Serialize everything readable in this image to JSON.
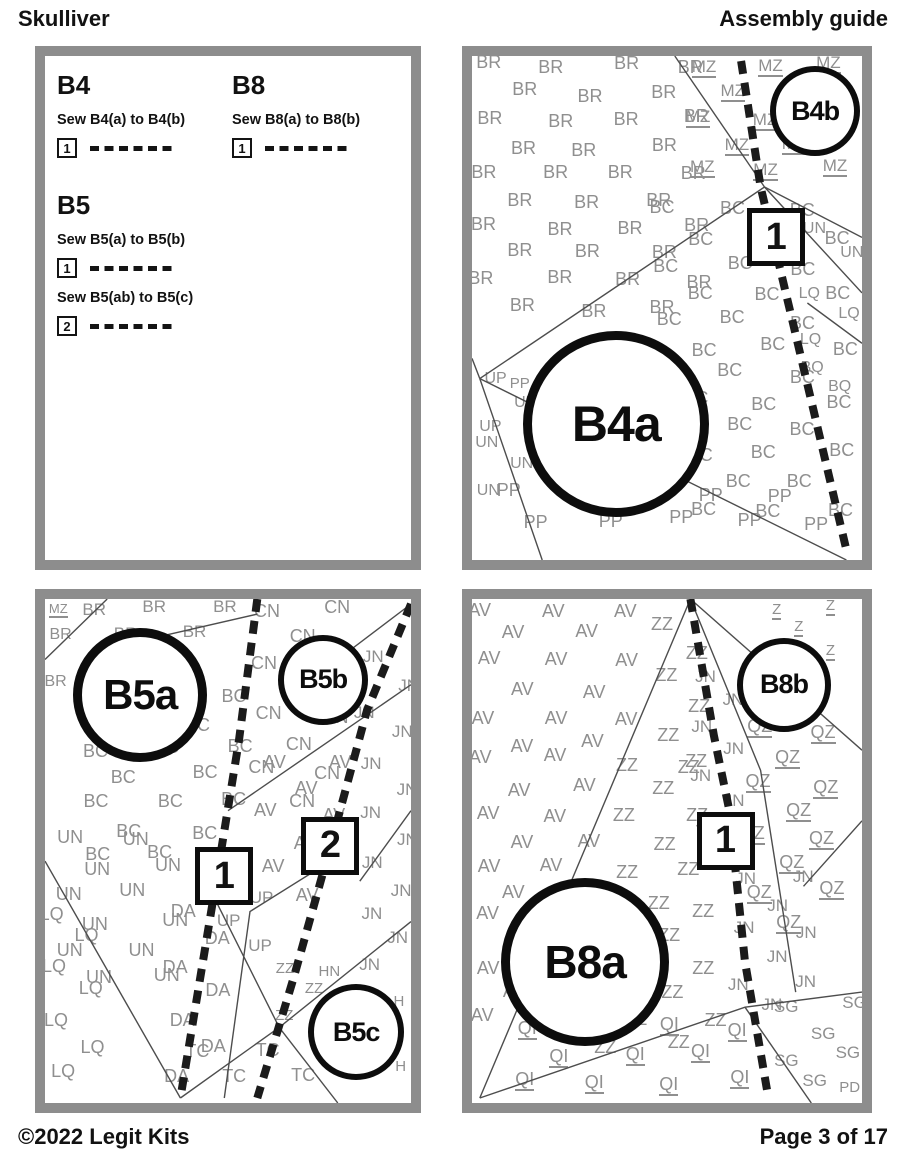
{
  "header": {
    "title_left": "Skulliver",
    "title_right": "Assembly guide"
  },
  "footer": {
    "copyright": "©2022 Legit Kits",
    "page": "Page 3 of 17"
  },
  "colors": {
    "panel_border": "#8d8d8d",
    "letters": "#8f8f8f",
    "thin_line": "#4d4d4d",
    "ink": "#0d0d0d",
    "paper": "#ffffff"
  },
  "instructions": {
    "groups": [
      {
        "title": "B4",
        "col": 0,
        "row": 0,
        "steps": [
          {
            "num": "1",
            "text": "Sew B4(a) to B4(b)"
          }
        ]
      },
      {
        "title": "B8",
        "col": 1,
        "row": 0,
        "steps": [
          {
            "num": "1",
            "text": "Sew B8(a) to B8(b)"
          }
        ]
      },
      {
        "title": "B5",
        "col": 0,
        "row": 1,
        "steps": [
          {
            "num": "1",
            "text": "Sew B5(a) to B5(b)"
          },
          {
            "num": "2",
            "text": "Sew B5(ab) to B5(c)"
          }
        ]
      }
    ]
  },
  "panels": [
    {
      "id": "B4",
      "circles": [
        {
          "label": "B4b",
          "x": 88,
          "y": 11,
          "r": 45,
          "fs": 27,
          "cls": "sm"
        },
        {
          "label": "B4a",
          "x": 37,
          "y": 73,
          "r": 93,
          "fs": 50,
          "cls": "lg"
        }
      ],
      "boxes": [
        {
          "num": "1",
          "x": 78,
          "y": 36
        }
      ],
      "dashed": [
        [
          [
            69,
            1
          ],
          [
            74,
            26
          ],
          [
            82,
            52
          ],
          [
            96,
            98
          ]
        ]
      ],
      "lines": [
        [
          [
            52,
            0
          ],
          [
            75,
            26
          ]
        ],
        [
          [
            75,
            26
          ],
          [
            100,
            36
          ]
        ],
        [
          [
            75,
            26
          ],
          [
            100,
            47
          ]
        ],
        [
          [
            75,
            26
          ],
          [
            2,
            64
          ]
        ],
        [
          [
            2,
            64
          ],
          [
            96,
            100
          ]
        ],
        [
          [
            2,
            64
          ],
          [
            18,
            100
          ]
        ],
        [
          [
            2,
            64
          ],
          [
            0,
            60
          ]
        ],
        [
          [
            86,
            49
          ],
          [
            100,
            57
          ]
        ]
      ],
      "fields": [
        {
          "code": "BR",
          "x": 0,
          "y": 0,
          "w": 64,
          "h": 54,
          "fs": 18
        },
        {
          "code": "MZ",
          "u": true,
          "x": 55,
          "y": 0,
          "w": 44,
          "h": 26,
          "fs": 17
        },
        {
          "code": "BR",
          "x": 91,
          "y": 15,
          "w": 8,
          "h": 6,
          "fs": 15
        },
        {
          "code": "BC",
          "x": 46,
          "y": 29,
          "w": 49,
          "h": 62,
          "fs": 18
        },
        {
          "code": "UN",
          "x": 86,
          "y": 33,
          "w": 13,
          "h": 9,
          "fs": 16
        },
        {
          "code": "LQ",
          "x": 85,
          "y": 45,
          "w": 14,
          "h": 13,
          "fs": 16
        },
        {
          "code": "BQ",
          "x": 83,
          "y": 60,
          "w": 16,
          "h": 10,
          "fs": 16
        },
        {
          "code": "UP",
          "x": 2,
          "y": 62,
          "w": 13,
          "h": 14,
          "fs": 16
        },
        {
          "code": "UN",
          "x": 1,
          "y": 75,
          "w": 15,
          "h": 14,
          "fs": 16
        },
        {
          "code": "PP",
          "x": 5,
          "y": 85,
          "w": 90,
          "h": 13,
          "fs": 18
        },
        {
          "code": "PP",
          "x": 11,
          "y": 63,
          "w": 10,
          "h": 11,
          "fs": 15
        }
      ]
    },
    {
      "id": "B5",
      "circles": [
        {
          "label": "B5a",
          "x": 26,
          "y": 19,
          "r": 67,
          "fs": 42,
          "cls": "lg"
        },
        {
          "label": "B5b",
          "x": 76,
          "y": 16,
          "r": 45,
          "fs": 27,
          "cls": "sm"
        },
        {
          "label": "B5c",
          "x": 85,
          "y": 86,
          "r": 48,
          "fs": 27,
          "cls": "sm"
        }
      ],
      "boxes": [
        {
          "num": "1",
          "x": 49,
          "y": 55
        },
        {
          "num": "2",
          "x": 78,
          "y": 49
        }
      ],
      "dashed": [
        [
          [
            58,
            0
          ],
          [
            53,
            28
          ],
          [
            47,
            55
          ],
          [
            42,
            77
          ],
          [
            37,
            99
          ]
        ],
        [
          [
            100,
            1
          ],
          [
            88,
            22
          ],
          [
            78,
            49
          ],
          [
            68,
            75
          ],
          [
            58,
            99
          ]
        ]
      ],
      "lines": [
        [
          [
            0,
            12
          ],
          [
            17,
            0
          ]
        ],
        [
          [
            28,
            8
          ],
          [
            58,
            3
          ]
        ],
        [
          [
            80,
            12
          ],
          [
            100,
            1
          ]
        ],
        [
          [
            50,
            42
          ],
          [
            100,
            17
          ]
        ],
        [
          [
            0,
            52
          ],
          [
            37,
            99
          ]
        ],
        [
          [
            37,
            99
          ],
          [
            64,
            85
          ]
        ],
        [
          [
            64,
            85
          ],
          [
            44,
            56
          ]
        ],
        [
          [
            64,
            85
          ],
          [
            100,
            64
          ]
        ],
        [
          [
            64,
            85
          ],
          [
            80,
            100
          ]
        ],
        [
          [
            78,
            52
          ],
          [
            56,
            62
          ],
          [
            49,
            99
          ]
        ],
        [
          [
            100,
            42
          ],
          [
            86,
            56
          ]
        ]
      ],
      "fields": [
        {
          "code": "MZ",
          "u": true,
          "x": 1,
          "y": 0,
          "w": 9,
          "h": 6,
          "fs": 13
        },
        {
          "code": "BR",
          "x": 10,
          "y": 0,
          "w": 48,
          "h": 12,
          "fs": 17
        },
        {
          "code": "BR",
          "x": 0,
          "y": 6,
          "w": 12,
          "h": 16,
          "fs": 16
        },
        {
          "code": "BC",
          "x": 10,
          "y": 17,
          "w": 46,
          "h": 35,
          "fs": 18
        },
        {
          "code": "CN",
          "x": 56,
          "y": 0,
          "w": 32,
          "h": 42,
          "fs": 18
        },
        {
          "code": "AV",
          "x": 58,
          "y": 30,
          "w": 30,
          "h": 32,
          "fs": 18
        },
        {
          "code": "JN",
          "x": 86,
          "y": 10,
          "w": 13,
          "h": 68,
          "fs": 17
        },
        {
          "code": "UN",
          "x": 2,
          "y": 46,
          "w": 38,
          "h": 34,
          "fs": 18
        },
        {
          "code": "LQ",
          "x": 0,
          "y": 60,
          "w": 21,
          "h": 38,
          "fs": 18
        },
        {
          "code": "DA",
          "x": 33,
          "y": 60,
          "w": 21,
          "h": 36,
          "fs": 18
        },
        {
          "code": "UP",
          "x": 48,
          "y": 52,
          "w": 20,
          "h": 22,
          "fs": 17
        },
        {
          "code": "ZZ",
          "x": 62,
          "y": 72,
          "w": 15,
          "h": 13,
          "fs": 15
        },
        {
          "code": "HN",
          "x": 74,
          "y": 72,
          "w": 9,
          "h": 7,
          "fs": 15
        },
        {
          "code": "TC",
          "x": 38,
          "y": 88,
          "w": 34,
          "h": 11,
          "fs": 18
        },
        {
          "code": "H",
          "x": 96,
          "y": 78,
          "w": 5,
          "h": 7,
          "fs": 15
        },
        {
          "code": "G",
          "x": 95,
          "y": 85,
          "w": 5,
          "h": 7,
          "fs": 15
        },
        {
          "code": "H",
          "x": 96,
          "y": 91,
          "w": 5,
          "h": 6,
          "fs": 15
        }
      ]
    },
    {
      "id": "B8",
      "circles": [
        {
          "label": "B8b",
          "x": 80,
          "y": 17,
          "r": 47,
          "fs": 27,
          "cls": "sm"
        },
        {
          "label": "B8a",
          "x": 29,
          "y": 72,
          "r": 84,
          "fs": 46,
          "cls": "lg"
        }
      ],
      "boxes": [
        {
          "num": "1",
          "x": 65,
          "y": 48
        }
      ],
      "dashed": [
        [
          [
            56,
            0
          ],
          [
            62,
            27
          ],
          [
            66,
            42
          ],
          [
            70,
            72
          ],
          [
            76,
            99
          ]
        ]
      ],
      "lines": [
        [
          [
            56,
            0
          ],
          [
            2,
            99
          ]
        ],
        [
          [
            56,
            0
          ],
          [
            100,
            30
          ]
        ],
        [
          [
            56,
            0
          ],
          [
            74,
            34
          ],
          [
            83,
            78
          ]
        ],
        [
          [
            2,
            99
          ],
          [
            70,
            81
          ],
          [
            100,
            78
          ]
        ],
        [
          [
            70,
            81
          ],
          [
            87,
            100
          ]
        ],
        [
          [
            100,
            44
          ],
          [
            85,
            57
          ]
        ]
      ],
      "fields": [
        {
          "code": "AV",
          "x": 0,
          "y": 0,
          "w": 44,
          "h": 30,
          "fs": 18
        },
        {
          "code": "AV",
          "x": 0,
          "y": 30,
          "w": 34,
          "h": 30,
          "fs": 18
        },
        {
          "code": "AV",
          "x": 0,
          "y": 60,
          "w": 22,
          "h": 28,
          "fs": 18
        },
        {
          "code": "ZZ",
          "x": 46,
          "y": 3,
          "w": 20,
          "h": 30,
          "fs": 18
        },
        {
          "code": "ZZ",
          "x": 36,
          "y": 31,
          "w": 28,
          "h": 30,
          "fs": 18
        },
        {
          "code": "ZZ",
          "x": 22,
          "y": 60,
          "w": 40,
          "h": 34,
          "fs": 18
        },
        {
          "code": "Z",
          "u": true,
          "x": 76,
          "y": 0,
          "w": 23,
          "h": 13,
          "fs": 15
        },
        {
          "code": "QZ",
          "u": true,
          "x": 70,
          "y": 24,
          "w": 28,
          "h": 44,
          "fs": 18
        },
        {
          "code": "JN",
          "x": 56,
          "y": 13,
          "w": 13,
          "h": 36,
          "fs": 17
        },
        {
          "code": "JN",
          "x": 66,
          "y": 54,
          "w": 26,
          "h": 30,
          "fs": 17
        },
        {
          "code": "QI",
          "u": true,
          "x": 12,
          "y": 83,
          "w": 62,
          "h": 15,
          "fs": 18
        },
        {
          "code": "SG",
          "x": 77,
          "y": 79,
          "w": 21,
          "h": 18,
          "fs": 17
        },
        {
          "code": "PD",
          "x": 93,
          "y": 95,
          "w": 6,
          "h": 4,
          "fs": 15
        }
      ]
    }
  ]
}
